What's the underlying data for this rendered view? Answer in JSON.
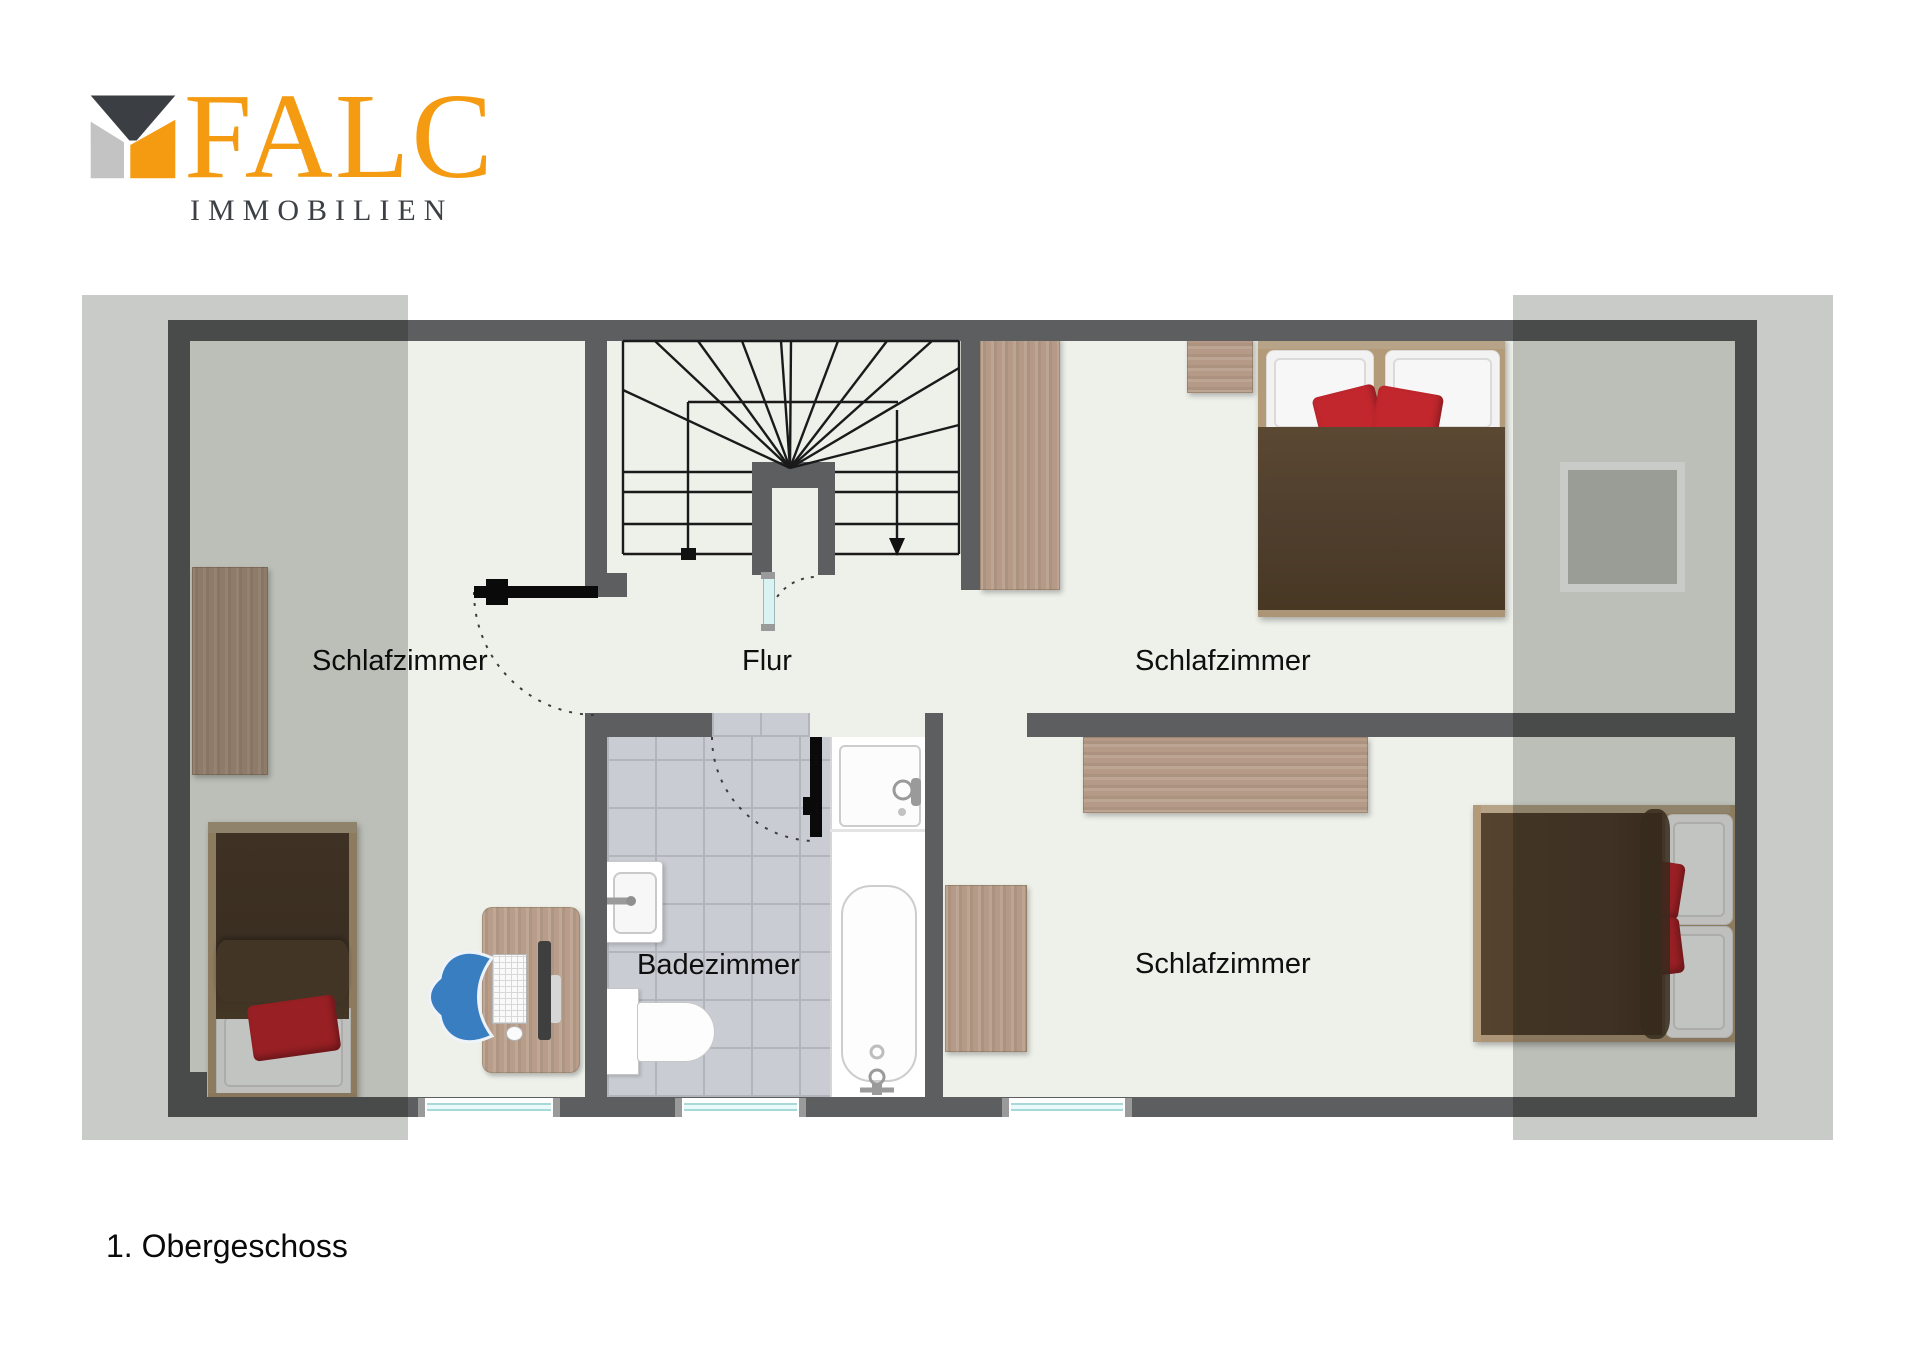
{
  "logo": {
    "brand": "FALC",
    "subtitle": "IMMOBILIEN",
    "icon": "falc-house-icon",
    "colors": {
      "orange": "#f49b12",
      "dark_gray": "#3b3e43",
      "light_gray": "#c3c3c3"
    }
  },
  "title": "1. Obergeschoss",
  "floor_plan": {
    "labels": {
      "bedroom_left": "Schlafzimmer",
      "hall": "Flur",
      "bedroom_top_right": "Schlafzimmer",
      "bathroom": "Badezimmer",
      "bedroom_bottom_right": "Schlafzimmer"
    },
    "rooms": [
      {
        "name": "Schlafzimmer",
        "position": "left",
        "furniture": [
          "dresser",
          "single-bed",
          "desk",
          "office-chair",
          "monitor",
          "keyboard",
          "mouse"
        ]
      },
      {
        "name": "Flur",
        "position": "center-top",
        "furniture": [
          "winder-staircase",
          "under-stair-door"
        ]
      },
      {
        "name": "Schlafzimmer",
        "position": "top-right",
        "furniture": [
          "wardrobe",
          "nightstand",
          "double-bed",
          "framed-panel"
        ]
      },
      {
        "name": "Badezimmer",
        "position": "center-bottom",
        "furniture": [
          "sink",
          "toilet",
          "shower-tray",
          "bathtub"
        ]
      },
      {
        "name": "Schlafzimmer",
        "position": "bottom-right",
        "furniture": [
          "sideboard",
          "cabinet",
          "double-bed"
        ]
      }
    ],
    "windows_bottom_wall": 3,
    "doors": [
      "bedroom-left-door",
      "bathroom-door",
      "under-stair-door"
    ],
    "stair_direction_arrow": "down",
    "colors": {
      "wall": "#5c5e60",
      "floor": "#eef0ea",
      "roof_slope_overlay": "#c9cbc8",
      "tiles": "#c9cdd3",
      "wood": "#b59b87",
      "bed_frame": "#b39b79",
      "duvet_brown": "#4f3e2d",
      "cushion_red": "#c1272d",
      "pillow_white": "#f2f2f2",
      "chair_blue": "#3a7ec2",
      "window_glass": "#a7d9d9"
    }
  }
}
